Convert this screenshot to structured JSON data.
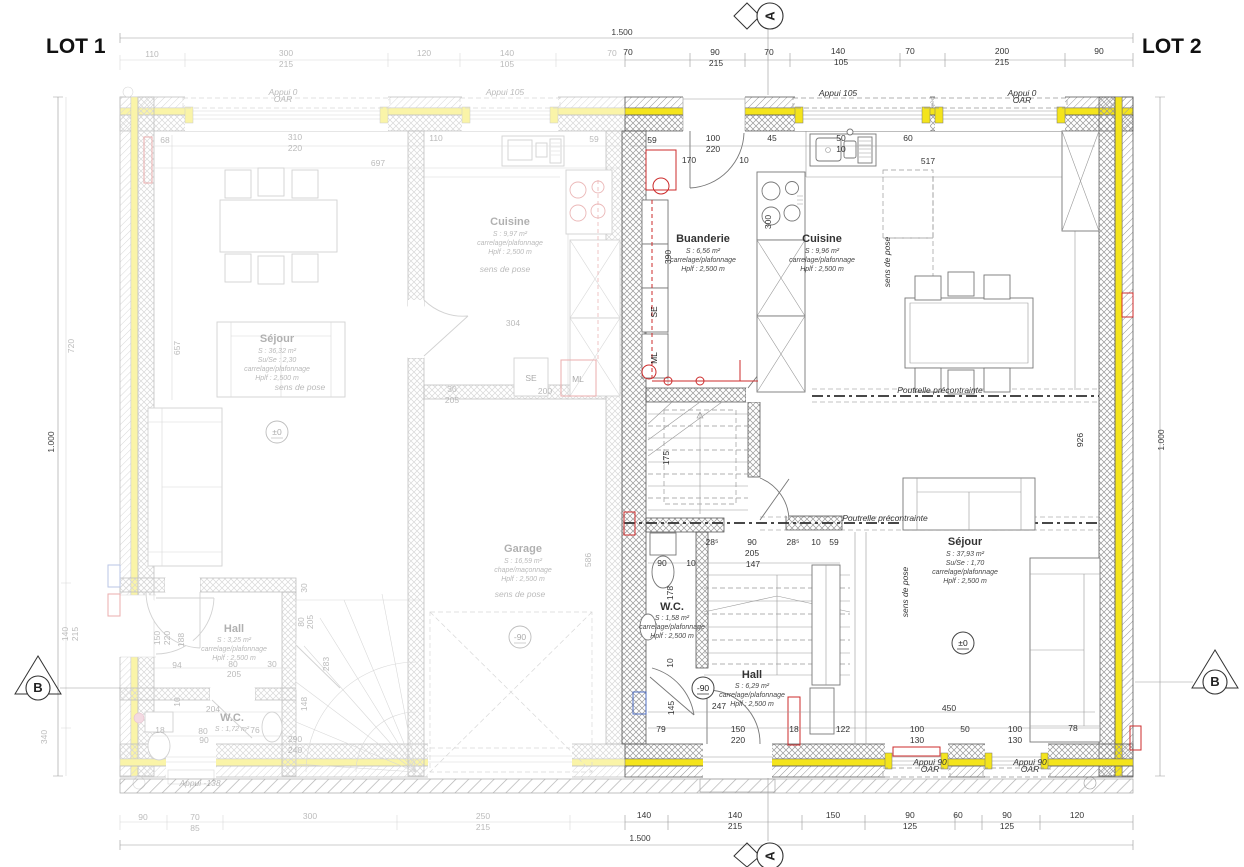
{
  "titles": {
    "lot1": "LOT 1",
    "lot2": "LOT 2"
  },
  "markers": {
    "a": "A",
    "b": "B"
  },
  "levels": {
    "zero": "±0",
    "minus": "-90"
  },
  "appliances": {
    "se": "SE",
    "ml": "ML"
  },
  "rooms": {
    "lot1": {
      "cuisine": {
        "name": "Cuisine",
        "l1": "S : 9,97 m²",
        "l2": "carrelage/plafonnage",
        "l3": "Hplf : 2,500 m"
      },
      "sejour": {
        "name": "Séjour",
        "l1": "S : 36,32 m²",
        "l2": "Su/Se : 2,30",
        "l3": "carrelage/plafonnage",
        "l4": "Hplf : 2,500 m"
      },
      "hall": {
        "name": "Hall",
        "l1": "S : 3,25 m²",
        "l2": "carrelage/plafonnage",
        "l3": "Hplf : 2,500 m"
      },
      "wc": {
        "name": "W.C.",
        "l1": "S : 1,72 m²"
      },
      "garage": {
        "name": "Garage",
        "l1": "S : 16,59 m²",
        "l2": "chape/maçonnage",
        "l3": "Hplf : 2,500 m"
      }
    },
    "lot2": {
      "buanderie": {
        "name": "Buanderie",
        "l1": "S : 6,56 m²",
        "l2": "carrelage/plafonnage",
        "l3": "Hplf : 2,500 m"
      },
      "cuisine": {
        "name": "Cuisine",
        "l1": "S : 9,96 m²",
        "l2": "carrelage/plafonnage",
        "l3": "Hplf : 2,500 m"
      },
      "sejour": {
        "name": "Séjour",
        "l1": "S : 37,93 m²",
        "l2": "Su/Se : 1,70",
        "l3": "carrelage/plafonnage",
        "l4": "Hplf : 2,500 m"
      },
      "wc": {
        "name": "W.C.",
        "l1": "S : 1,58 m²",
        "l2": "carrelage/plafonnage",
        "l3": "Hplf : 2,500 m"
      },
      "hall": {
        "name": "Hall",
        "l1": "S : 6,29 m²",
        "l2": "carrelage/plafonnage",
        "l3": "Hplf : 2,500 m"
      }
    }
  },
  "colors": {
    "insulation_lot2": "#f4e41c",
    "accent_red": "#cc2b2b",
    "accent_blue": "#4d6cc0"
  },
  "annotations": {
    "shared": [
      {
        "t": "1.500",
        "x": 622,
        "y": 35
      },
      {
        "t": "1.500",
        "x": 640,
        "y": 841
      },
      {
        "t": "1.000",
        "x": 54,
        "y": 442,
        "r": -90
      },
      {
        "t": "1.000",
        "x": 1164,
        "y": 440,
        "r": -90
      }
    ],
    "lot1": [
      {
        "t": "110",
        "x": 152,
        "y": 57
      },
      {
        "t": "300",
        "x": 286,
        "y": 56
      },
      {
        "t": "215",
        "x": 286,
        "y": 67
      },
      {
        "t": "120",
        "x": 424,
        "y": 56
      },
      {
        "t": "140",
        "x": 507,
        "y": 56
      },
      {
        "t": "105",
        "x": 507,
        "y": 67
      },
      {
        "t": "70",
        "x": 612,
        "y": 56
      },
      {
        "t": "68",
        "x": 165,
        "y": 143
      },
      {
        "t": "310",
        "x": 295,
        "y": 140
      },
      {
        "t": "220",
        "x": 295,
        "y": 151
      },
      {
        "t": "110",
        "x": 436,
        "y": 141
      },
      {
        "t": "59",
        "x": 594,
        "y": 142
      },
      {
        "t": "697",
        "x": 378,
        "y": 166
      },
      {
        "t": "720",
        "x": 74,
        "y": 346,
        "r": -90
      },
      {
        "t": "657",
        "x": 180,
        "y": 348,
        "r": -90
      },
      {
        "t": "140",
        "x": 68,
        "y": 634,
        "r": -90
      },
      {
        "t": "215",
        "x": 78,
        "y": 634,
        "r": -90
      },
      {
        "t": "340",
        "x": 47,
        "y": 737,
        "r": -90
      },
      {
        "t": "304",
        "x": 513,
        "y": 326
      },
      {
        "t": "30",
        "x": 452,
        "y": 392
      },
      {
        "t": "205",
        "x": 452,
        "y": 403
      },
      {
        "t": "200",
        "x": 545,
        "y": 394
      },
      {
        "t": "94",
        "x": 177,
        "y": 668
      },
      {
        "t": "80",
        "x": 233,
        "y": 667
      },
      {
        "t": "30",
        "x": 272,
        "y": 667
      },
      {
        "t": "205",
        "x": 234,
        "y": 677
      },
      {
        "t": "204",
        "x": 213,
        "y": 712
      },
      {
        "t": "18",
        "x": 160,
        "y": 733
      },
      {
        "t": "80",
        "x": 203,
        "y": 734
      },
      {
        "t": "90",
        "x": 204,
        "y": 743
      },
      {
        "t": "76",
        "x": 255,
        "y": 733
      },
      {
        "t": "150",
        "x": 160,
        "y": 638,
        "r": -90
      },
      {
        "t": "220",
        "x": 170,
        "y": 638,
        "r": -90
      },
      {
        "t": "188",
        "x": 184,
        "y": 640,
        "r": -90
      },
      {
        "t": "10",
        "x": 180,
        "y": 702,
        "r": -90
      },
      {
        "t": "148",
        "x": 307,
        "y": 704,
        "r": -90
      },
      {
        "t": "283",
        "x": 329,
        "y": 664,
        "r": -90
      },
      {
        "t": "80",
        "x": 304,
        "y": 622,
        "r": -90
      },
      {
        "t": "205",
        "x": 313,
        "y": 622,
        "r": -90
      },
      {
        "t": "30",
        "x": 307,
        "y": 588,
        "r": -90
      },
      {
        "t": "586",
        "x": 591,
        "y": 560,
        "r": -90
      },
      {
        "t": "290",
        "x": 295,
        "y": 742
      },
      {
        "t": "240",
        "x": 295,
        "y": 753
      },
      {
        "t": "90",
        "x": 143,
        "y": 820
      },
      {
        "t": "70",
        "x": 195,
        "y": 820
      },
      {
        "t": "85",
        "x": 195,
        "y": 831
      },
      {
        "t": "300",
        "x": 310,
        "y": 819
      },
      {
        "t": "250",
        "x": 483,
        "y": 819
      },
      {
        "t": "215",
        "x": 483,
        "y": 830
      },
      {
        "t": "Appui 0",
        "x": 283,
        "y": 95,
        "c": "note"
      },
      {
        "t": "OAR",
        "x": 283,
        "y": 102,
        "c": "note"
      },
      {
        "t": "Appui 105",
        "x": 505,
        "y": 95,
        "c": "note"
      },
      {
        "t": "Appui -138",
        "x": 200,
        "y": 786,
        "c": "note"
      },
      {
        "t": "sens de pose",
        "x": 505,
        "y": 272,
        "c": "note"
      },
      {
        "t": "sens de pose",
        "x": 300,
        "y": 390,
        "c": "note"
      },
      {
        "t": "sens de pose",
        "x": 520,
        "y": 597,
        "c": "note"
      }
    ],
    "lot2": [
      {
        "t": "70",
        "x": 628,
        "y": 55
      },
      {
        "t": "90",
        "x": 715,
        "y": 55
      },
      {
        "t": "215",
        "x": 716,
        "y": 66
      },
      {
        "t": "70",
        "x": 769,
        "y": 55
      },
      {
        "t": "140",
        "x": 838,
        "y": 54
      },
      {
        "t": "105",
        "x": 841,
        "y": 65
      },
      {
        "t": "70",
        "x": 910,
        "y": 54
      },
      {
        "t": "200",
        "x": 1002,
        "y": 54
      },
      {
        "t": "215",
        "x": 1002,
        "y": 65
      },
      {
        "t": "90",
        "x": 1099,
        "y": 54
      },
      {
        "t": "59",
        "x": 652,
        "y": 143
      },
      {
        "t": "100",
        "x": 713,
        "y": 141
      },
      {
        "t": "220",
        "x": 713,
        "y": 152
      },
      {
        "t": "170",
        "x": 689,
        "y": 163
      },
      {
        "t": "10",
        "x": 744,
        "y": 163
      },
      {
        "t": "45",
        "x": 772,
        "y": 141
      },
      {
        "t": "50",
        "x": 841,
        "y": 141
      },
      {
        "t": "10",
        "x": 841,
        "y": 152
      },
      {
        "t": "60",
        "x": 908,
        "y": 141
      },
      {
        "t": "517",
        "x": 928,
        "y": 164
      },
      {
        "t": "300",
        "x": 771,
        "y": 222,
        "r": -90
      },
      {
        "t": "390",
        "x": 671,
        "y": 257,
        "r": -90
      },
      {
        "t": "926",
        "x": 1083,
        "y": 440,
        "r": -90
      },
      {
        "t": "175",
        "x": 669,
        "y": 458,
        "r": -90
      },
      {
        "t": "90",
        "x": 662,
        "y": 566
      },
      {
        "t": "10",
        "x": 691,
        "y": 566
      },
      {
        "t": "28⁵",
        "x": 712,
        "y": 545
      },
      {
        "t": "90",
        "x": 752,
        "y": 545
      },
      {
        "t": "205",
        "x": 752,
        "y": 556
      },
      {
        "t": "28⁵",
        "x": 793,
        "y": 545
      },
      {
        "t": "10",
        "x": 816,
        "y": 545
      },
      {
        "t": "59",
        "x": 834,
        "y": 545
      },
      {
        "t": "147",
        "x": 753,
        "y": 567
      },
      {
        "t": "178",
        "x": 673,
        "y": 593,
        "r": -90
      },
      {
        "t": "10",
        "x": 673,
        "y": 663,
        "r": -90
      },
      {
        "t": "145",
        "x": 674,
        "y": 708,
        "r": -90
      },
      {
        "t": "247",
        "x": 719,
        "y": 709
      },
      {
        "t": "450",
        "x": 949,
        "y": 711
      },
      {
        "t": "79",
        "x": 661,
        "y": 732
      },
      {
        "t": "150",
        "x": 738,
        "y": 732
      },
      {
        "t": "220",
        "x": 738,
        "y": 743
      },
      {
        "t": "18",
        "x": 794,
        "y": 732
      },
      {
        "t": "122",
        "x": 843,
        "y": 732
      },
      {
        "t": "100",
        "x": 917,
        "y": 732
      },
      {
        "t": "130",
        "x": 917,
        "y": 743
      },
      {
        "t": "50",
        "x": 965,
        "y": 732
      },
      {
        "t": "100",
        "x": 1015,
        "y": 732
      },
      {
        "t": "130",
        "x": 1015,
        "y": 743
      },
      {
        "t": "78",
        "x": 1073,
        "y": 731
      },
      {
        "t": "140",
        "x": 644,
        "y": 818
      },
      {
        "t": "140",
        "x": 735,
        "y": 818
      },
      {
        "t": "215",
        "x": 735,
        "y": 829
      },
      {
        "t": "150",
        "x": 833,
        "y": 818
      },
      {
        "t": "90",
        "x": 910,
        "y": 818
      },
      {
        "t": "125",
        "x": 910,
        "y": 829
      },
      {
        "t": "60",
        "x": 958,
        "y": 818
      },
      {
        "t": "90",
        "x": 1007,
        "y": 818
      },
      {
        "t": "125",
        "x": 1007,
        "y": 829
      },
      {
        "t": "120",
        "x": 1077,
        "y": 818
      },
      {
        "t": "Appui 105",
        "x": 838,
        "y": 96,
        "c": "note"
      },
      {
        "t": "Appui 0",
        "x": 1022,
        "y": 96,
        "c": "note"
      },
      {
        "t": "OAR",
        "x": 1022,
        "y": 103,
        "c": "note"
      },
      {
        "t": "Appui 90",
        "x": 930,
        "y": 765,
        "c": "note"
      },
      {
        "t": "OAR",
        "x": 930,
        "y": 772,
        "c": "note"
      },
      {
        "t": "Appui 90",
        "x": 1030,
        "y": 765,
        "c": "note"
      },
      {
        "t": "OAR",
        "x": 1030,
        "y": 772,
        "c": "note"
      },
      {
        "t": "Poutrelle précontrainte",
        "x": 940,
        "y": 393,
        "c": "note"
      },
      {
        "t": "Poutrelle précontrainte",
        "x": 885,
        "y": 521,
        "c": "note"
      },
      {
        "t": "sens de pose",
        "x": 890,
        "y": 262,
        "r": -90,
        "c": "note"
      },
      {
        "t": "sens de pose",
        "x": 908,
        "y": 592,
        "r": -90,
        "c": "note"
      }
    ]
  }
}
